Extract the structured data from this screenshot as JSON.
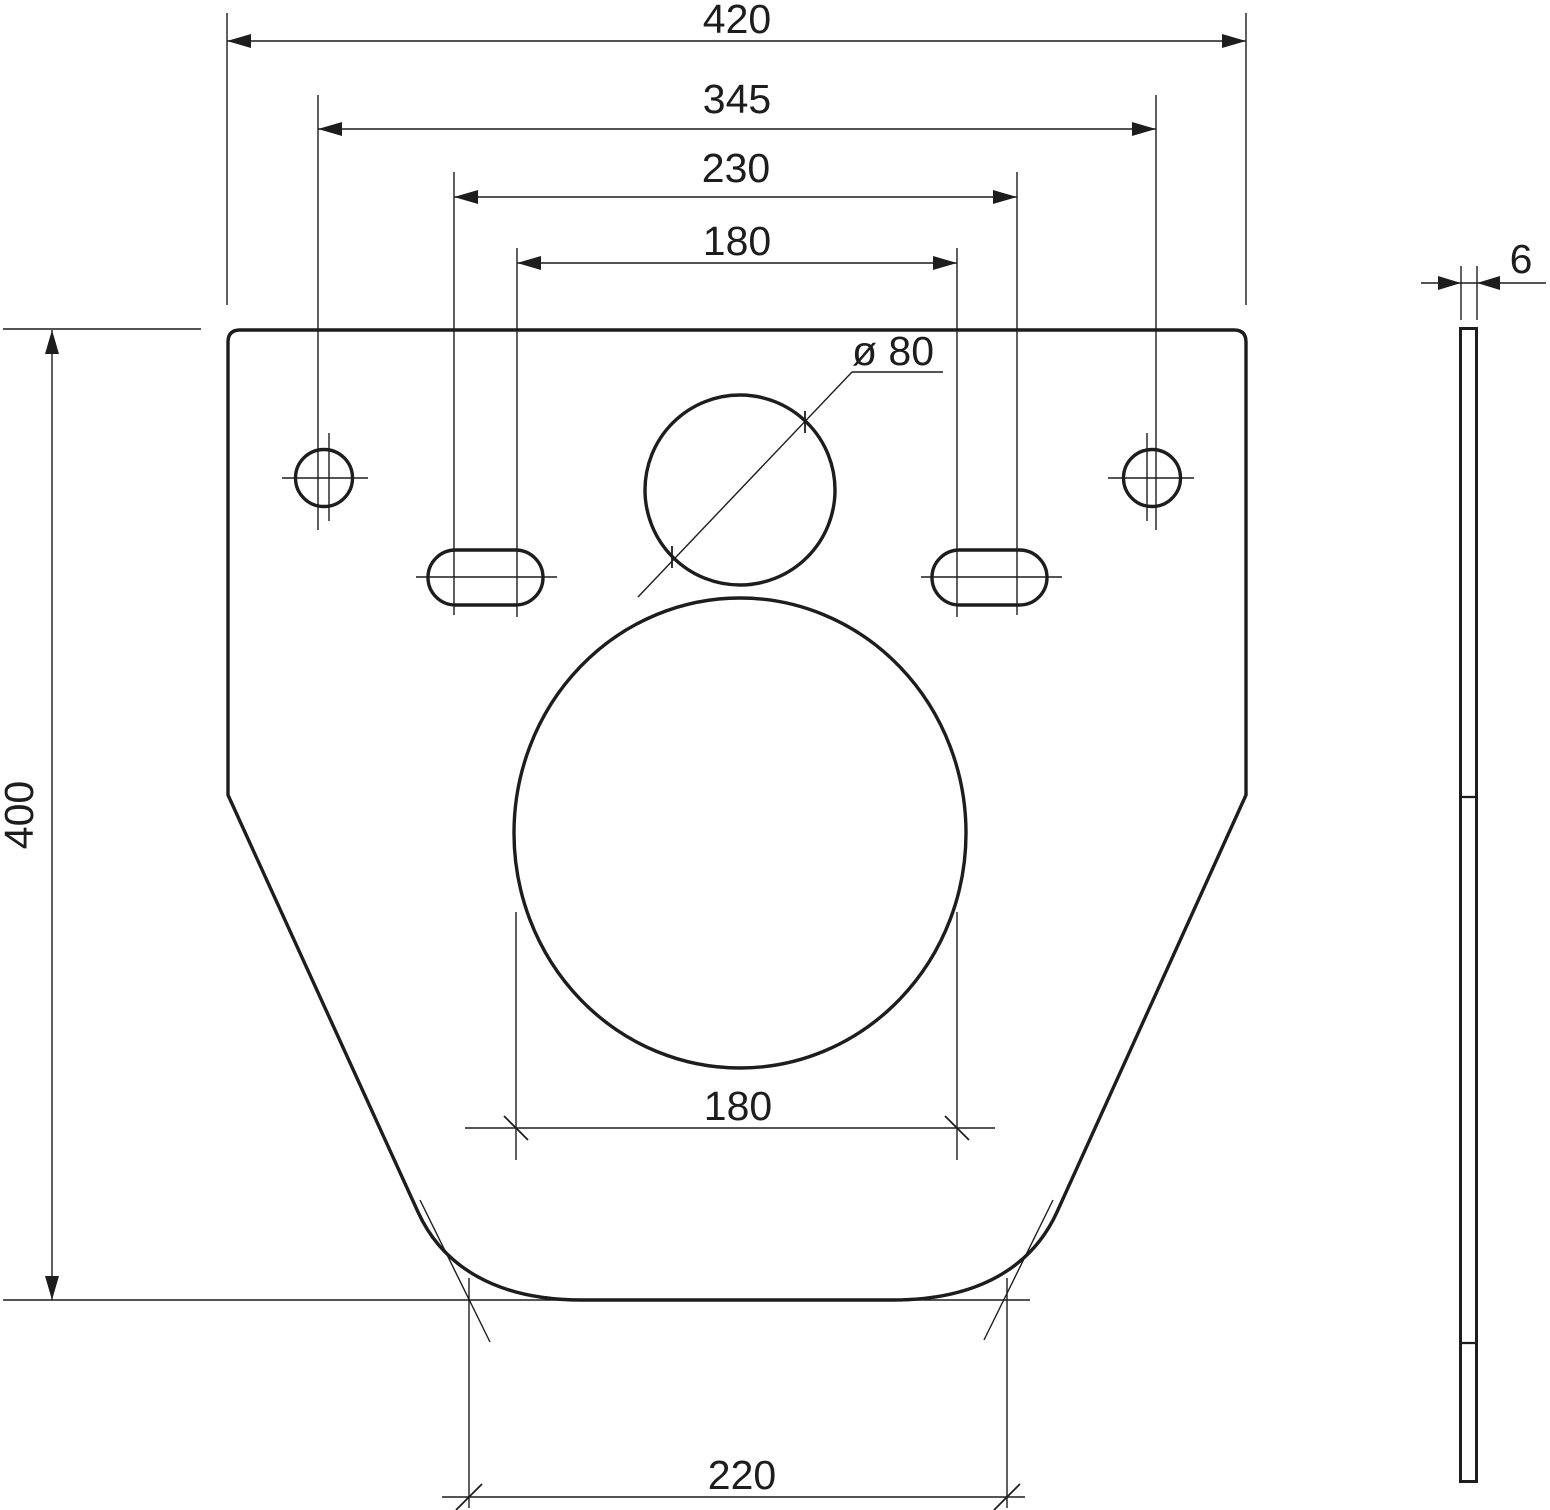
{
  "drawing": {
    "background": "#ffffff",
    "ink_color": "#1d1d1d",
    "view": "wall-hung toilet mounting / insulation plate, front view and side section",
    "labels": {
      "width_overall": "420",
      "hole_spacing": "345",
      "slot_spacing_outer": "230",
      "slot_spacing_inner": "180",
      "pipe_hole_diameter": "ø 80",
      "height_overall": "400",
      "opening_width": "180",
      "bottom_width": "220",
      "thickness": "6"
    }
  }
}
